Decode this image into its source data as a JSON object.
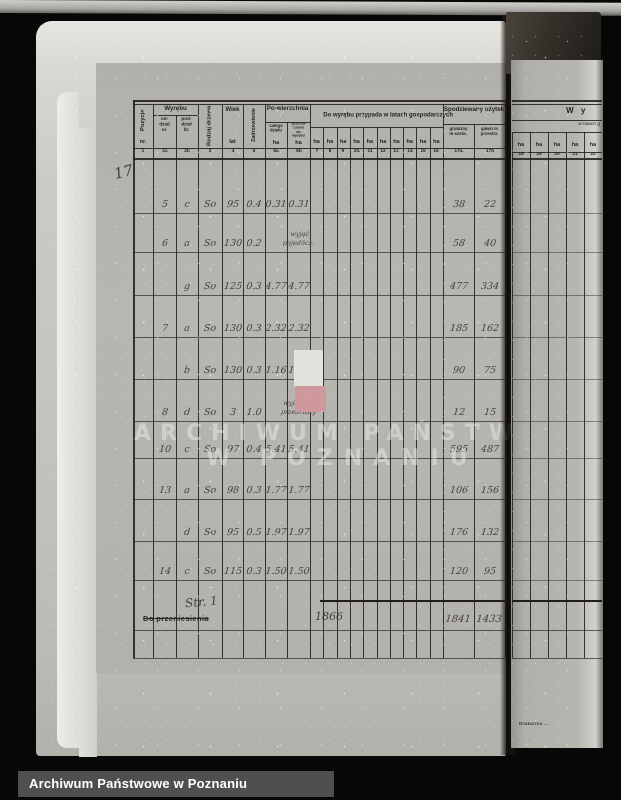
{
  "photo": {
    "bottom_bar_label": "Archiwum Państwowe w Poznaniu",
    "watermark_line1": "ARCHIWUM PAŃSTWOWE",
    "watermark_line2": "W POZNANIU",
    "margin_note": "17"
  },
  "colors": {
    "marker_red": "#cf989d",
    "marker_white": "#e4e2dd"
  },
  "table": {
    "headers": {
      "pozycja": "Pozycja",
      "pozycja_unit": "nr.",
      "wyrebu": "Wyrębu",
      "oddzial": "od-dział nr.",
      "poddzial": "pod-dział lit.",
      "rodzaj_drzewa": "Rodzaj drzewa",
      "wiek": "Wiek",
      "wiek_unit": "lat",
      "zadrzewienie": "Zadrzewienie",
      "powierzchnia": "Po-wierzchnia",
      "pow_calego": "całego działu",
      "pow_przeznaczona": "przezna-czona do wyrębu",
      "ha": "ha",
      "do_wyrebu": "Do wyrębu przypada w latach gospodarczych",
      "spodziewany": "Spodziewany użytek",
      "grubizny": "grubizny m-sześc.",
      "galezi": "gałęzi m przestrz.",
      "col_numbers": [
        "1",
        "2a",
        "2b",
        "3",
        "4",
        "5",
        "6a",
        "6b",
        "7",
        "8",
        "9",
        "10.",
        "11",
        "12",
        "13",
        "14",
        "15",
        "16",
        "17a.",
        "17b"
      ]
    },
    "rows": [
      {
        "oddzial": "5",
        "poddzial": "c",
        "rodzaj": "So",
        "wiek": "95",
        "zadrzewienie": "0.4",
        "pow_calego": "0.31",
        "pow_wyrebu": "0.31",
        "note": "",
        "grubizny": "38",
        "galezi": "22"
      },
      {
        "oddzial": "6",
        "poddzial": "a",
        "rodzaj": "So",
        "wiek": "130",
        "zadrzewienie": "0.2",
        "pow_calego": "",
        "pow_wyrebu": "",
        "note": "wyjąć\npojedńcz.",
        "grubizny": "58",
        "galezi": "40"
      },
      {
        "oddzial": "",
        "poddzial": "g",
        "rodzaj": "So",
        "wiek": "125",
        "zadrzewienie": "0.3",
        "pow_calego": "4.77",
        "pow_wyrebu": "4.77",
        "note": "",
        "grubizny": "477",
        "galezi": "334"
      },
      {
        "oddzial": "7",
        "poddzial": "a",
        "rodzaj": "So",
        "wiek": "130",
        "zadrzewienie": "0.3",
        "pow_calego": "2.32",
        "pow_wyrebu": "2.32",
        "note": "",
        "grubizny": "185",
        "galezi": "162"
      },
      {
        "oddzial": "",
        "poddzial": "b",
        "rodzaj": "So",
        "wiek": "130",
        "zadrzewienie": "0.3",
        "pow_calego": "1.16",
        "pow_wyrebu": "1.11",
        "note": "",
        "grubizny": "90",
        "galezi": "75"
      },
      {
        "oddzial": "8",
        "poddzial": "d",
        "rodzaj": "So",
        "wiek": "3",
        "zadrzewienie": "1.0",
        "pow_calego": "",
        "pow_wyrebu": "",
        "note": "wyjąć poj.\nprzedrosty",
        "grubizny": "12",
        "galezi": "15"
      },
      {
        "oddzial": "10",
        "poddzial": "c",
        "rodzaj": "So",
        "wiek": "97",
        "zadrzewienie": "0.4",
        "pow_calego": "5.41",
        "pow_wyrebu": "5.41",
        "note": "",
        "grubizny": "595",
        "galezi": "487"
      },
      {
        "oddzial": "13",
        "poddzial": "a",
        "rodzaj": "So",
        "wiek": "98",
        "zadrzewienie": "0.3",
        "pow_calego": "1.77",
        "pow_wyrebu": "1.77",
        "note": "",
        "grubizny": "106",
        "galezi": "156"
      },
      {
        "oddzial": "",
        "poddzial": "d",
        "rodzaj": "So",
        "wiek": "95",
        "zadrzewienie": "0.5",
        "pow_calego": "1.97",
        "pow_wyrebu": "1.97",
        "note": "",
        "grubizny": "176",
        "galezi": "132"
      },
      {
        "oddzial": "14",
        "poddzial": "c",
        "rodzaj": "So",
        "wiek": "115",
        "zadrzewienie": "0.3",
        "pow_calego": "1.50",
        "pow_wyrebu": "1.50",
        "note": "",
        "grubizny": "120",
        "galezi": "95"
      }
    ],
    "footer": {
      "page_note": "Str. 1",
      "carry_label": "Do przeniesienia",
      "carry_year": "1866",
      "total_grubizny": "1841",
      "total_galezi": "1433"
    }
  },
  "right_page": {
    "title": "W y",
    "subtitle": "w latach g",
    "ha": "ha",
    "col_numbers": [
      "18",
      "19",
      "20",
      "21",
      "22"
    ],
    "imprint": "Drukarnia …"
  }
}
